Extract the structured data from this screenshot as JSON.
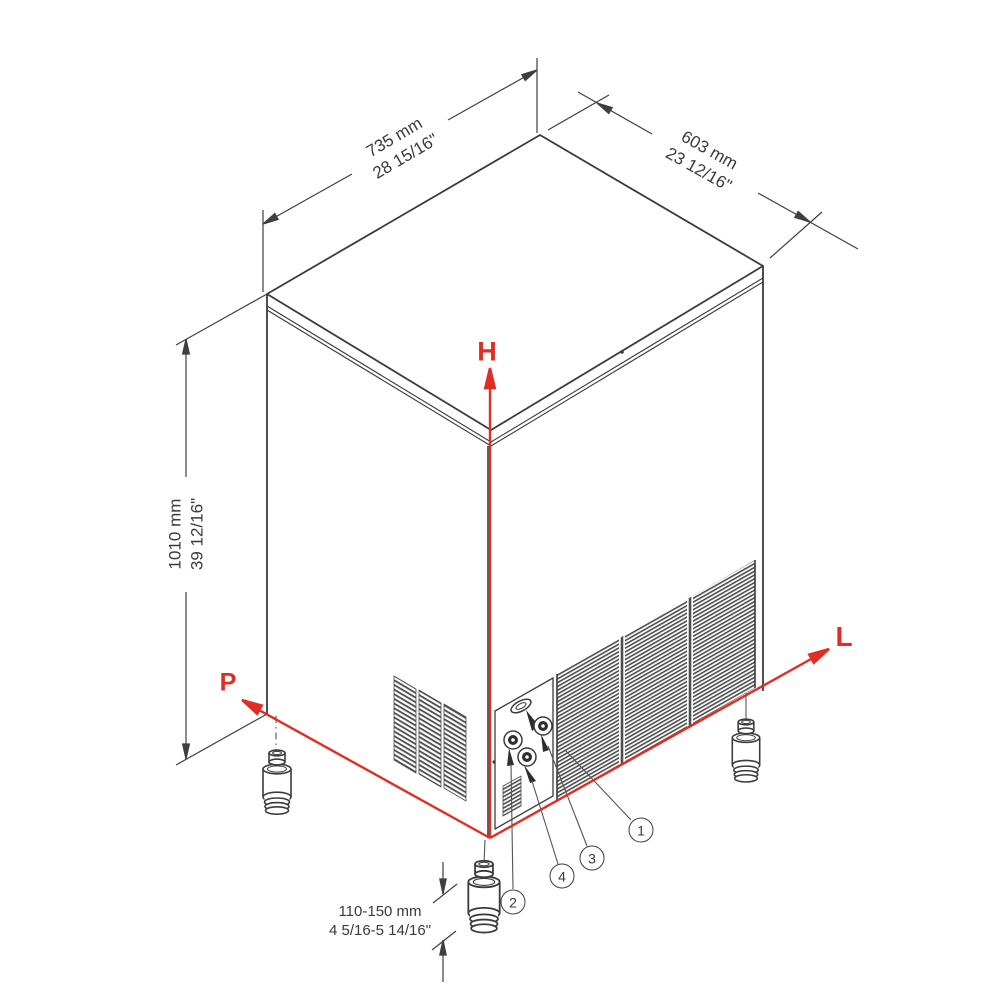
{
  "dims": {
    "width": {
      "mm": "735 mm",
      "inch": "28 15/16\""
    },
    "depth": {
      "mm": "603 mm",
      "inch": "23 12/16\""
    },
    "height": {
      "mm": "1010 mm",
      "inch": "39 12/16\""
    },
    "feet": {
      "mm": "110-150 mm",
      "inch": "4 5/16-5 14/16\""
    }
  },
  "axes": {
    "height": "H",
    "depth": "P",
    "width": "L"
  },
  "callouts": [
    "1",
    "2",
    "3",
    "4"
  ],
  "colors": {
    "line": "#3b3b3b",
    "accent_red": "#df2e23",
    "background": "#ffffff"
  }
}
